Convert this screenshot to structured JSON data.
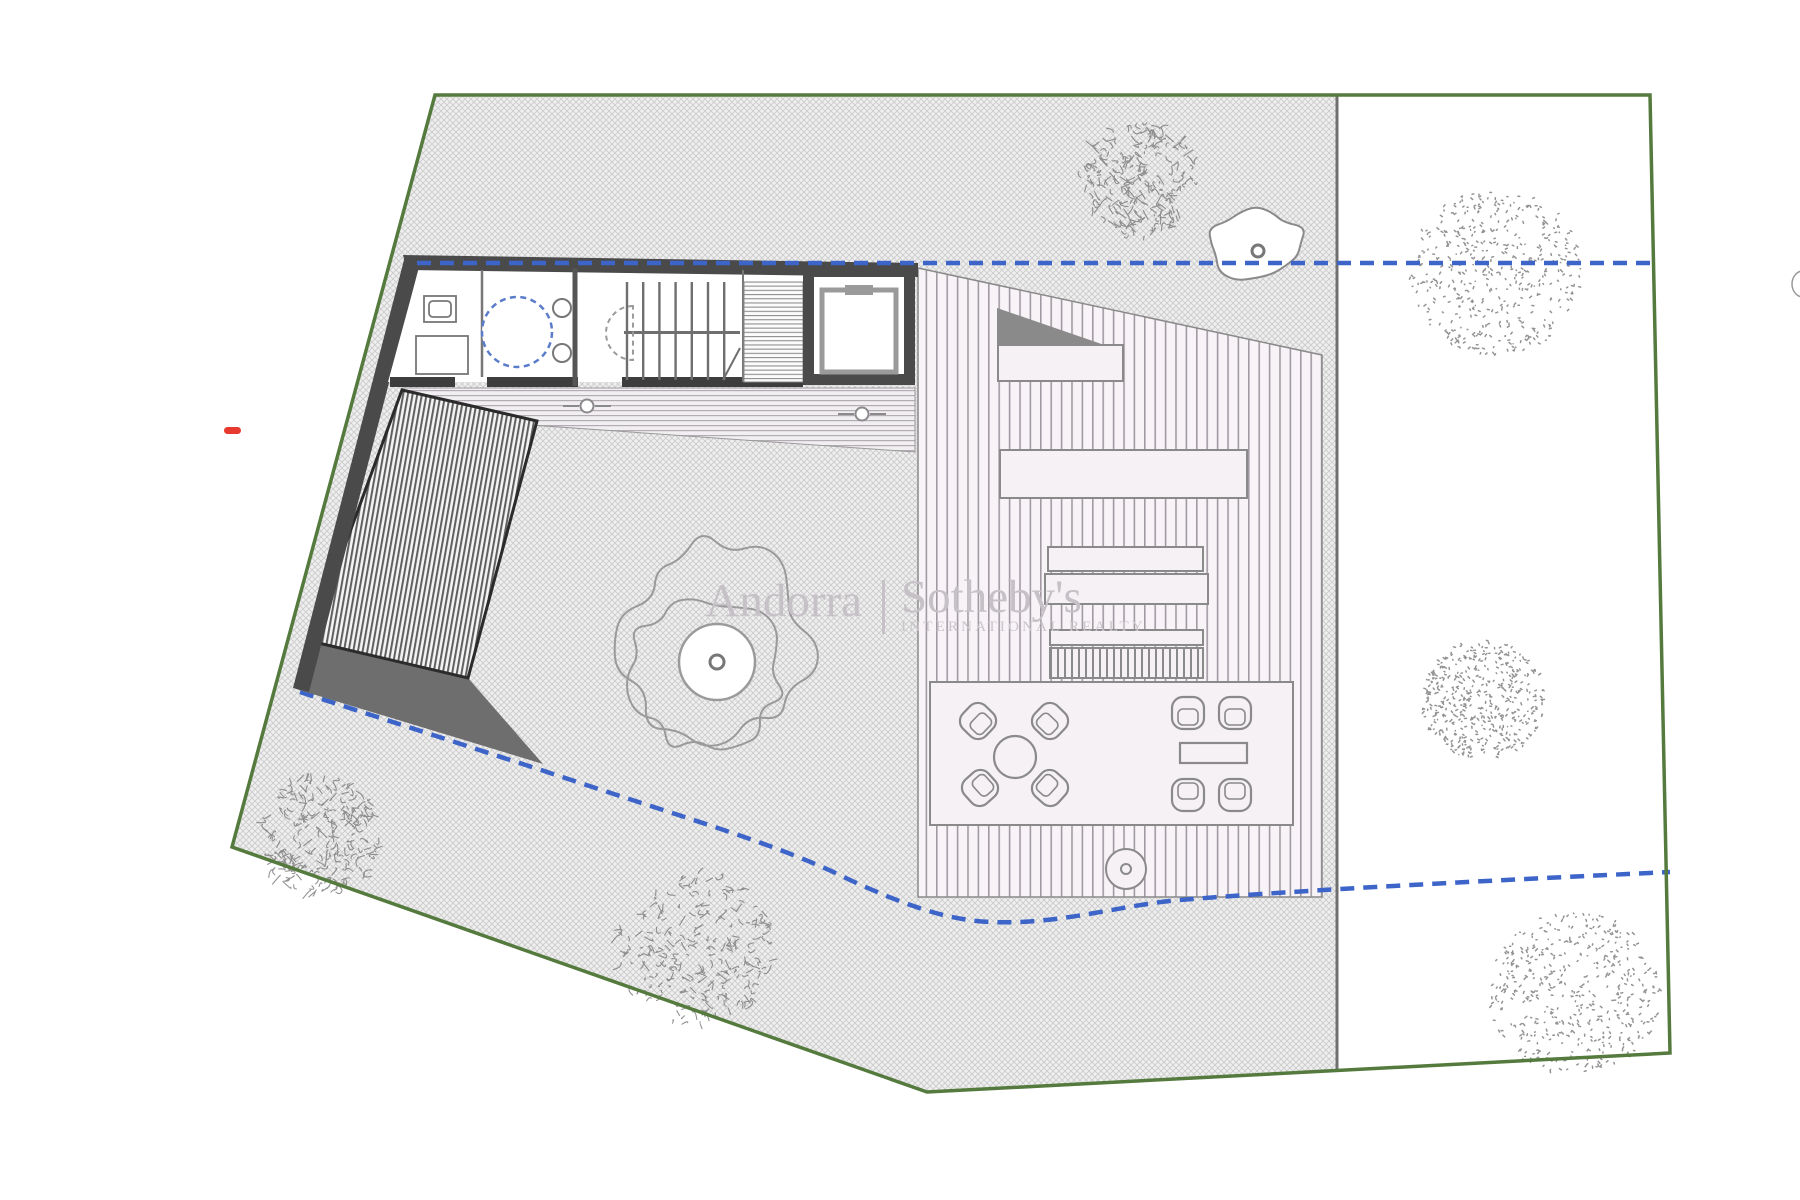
{
  "watermark": {
    "brand_left": "Andorra",
    "divider": "|",
    "brand_right": "Sotheby's",
    "subtitle": "INTERNATIONAL REALTY"
  },
  "colors": {
    "boundary_green": "#557a3e",
    "setback_blue": "#3d64c8",
    "marker_red": "#e8392e",
    "wall_dark": "#4a4a4a",
    "tree_gray": "#787878"
  },
  "site": {
    "trees": [
      {
        "x": 1140,
        "y": 180,
        "r": 60,
        "style": "scribble"
      },
      {
        "x": 1496,
        "y": 272,
        "r": 87,
        "style": "stipple"
      },
      {
        "x": 1483,
        "y": 700,
        "r": 62,
        "style": "stipple"
      },
      {
        "x": 1575,
        "y": 993,
        "r": 86,
        "style": "stipple"
      },
      {
        "x": 320,
        "y": 835,
        "r": 62,
        "style": "scribble"
      },
      {
        "x": 697,
        "y": 950,
        "r": 80,
        "style": "scribble"
      }
    ],
    "feature_tree": {
      "x": 717,
      "y": 662,
      "trunk_r": 38,
      "dot_r": 7,
      "canopy_rx": 96,
      "canopy_ry": 100
    },
    "rock": {
      "x": 1256,
      "y": 243,
      "rx": 47,
      "ry": 36,
      "dot_x": 1258,
      "dot_y": 251,
      "dot_r": 6
    }
  },
  "plan": {
    "furniture": {
      "round_table": {
        "x": 1015,
        "y": 757,
        "r": 21
      },
      "rect_table": {
        "x": 1180,
        "y": 743,
        "w": 67,
        "h": 20
      },
      "fire_pit": {
        "x": 1126,
        "y": 869,
        "r": 20,
        "dot_r": 5
      },
      "chairs": [
        {
          "x": 978,
          "y": 721,
          "rot": -46
        },
        {
          "x": 1050,
          "y": 721,
          "rot": 44
        },
        {
          "x": 980,
          "y": 788,
          "rot": -132
        },
        {
          "x": 1050,
          "y": 788,
          "rot": 132
        },
        {
          "x": 1188,
          "y": 713,
          "rot": 0
        },
        {
          "x": 1235,
          "y": 713,
          "rot": 0
        },
        {
          "x": 1188,
          "y": 795,
          "rot": 180
        },
        {
          "x": 1235,
          "y": 795,
          "rot": 180
        }
      ]
    },
    "stairs": {
      "x0": 627,
      "x1": 740,
      "step": 16.2,
      "top_y0": 282,
      "top_y1": 331,
      "bot_y0": 334,
      "bot_y1": 380
    }
  }
}
